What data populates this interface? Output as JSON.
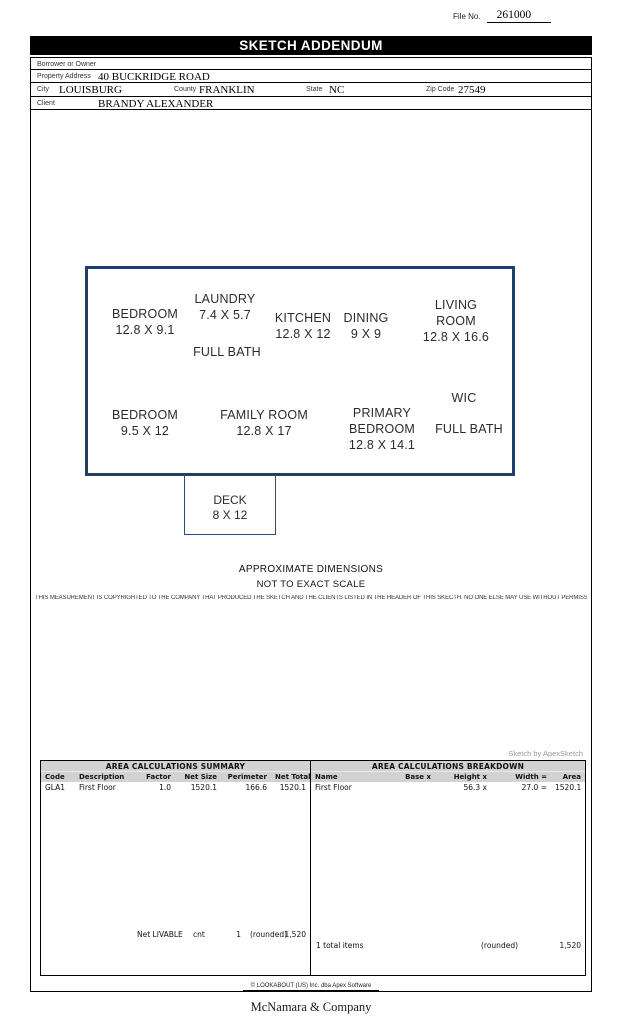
{
  "page": {
    "file_no_label": "File No.",
    "file_no_value": "261000",
    "banner_title": "SKETCH ADDENDUM"
  },
  "form": {
    "borrower_label": "Borrower or Owner",
    "property_address_label": "Property Address",
    "property_address_value": "40 BUCKRIDGE ROAD",
    "city_label": "City",
    "city_value": "LOUISBURG",
    "county_label": "County",
    "county_value": "FRANKLIN",
    "state_label": "State",
    "state_value": "NC",
    "zip_label": "Zip Code",
    "zip_value": "27549",
    "client_label": "Client",
    "client_value": "BRANDY ALEXANDER"
  },
  "sketch": {
    "border_color": "#1f3f63",
    "rooms": [
      {
        "name": "BEDROOM",
        "dims": "12.8 X 9.1"
      },
      {
        "name": "LAUNDRY",
        "dims": "7.4 X 5.7"
      },
      {
        "name": "FULL BATH",
        "dims": ""
      },
      {
        "name": "KITCHEN",
        "dims": "12.8 X 12"
      },
      {
        "name": "DINING",
        "dims": "9 X 9"
      },
      {
        "name": "LIVING ROOM",
        "dims": "12.8 X 16.6"
      },
      {
        "name": "BEDROOM",
        "dims": "9.5 X 12"
      },
      {
        "name": "FAMILY ROOM",
        "dims": "12.8 X 17"
      },
      {
        "name": "PRIMARY BEDROOM",
        "dims": "12.8 X 14.1"
      },
      {
        "name": "WIC",
        "dims": ""
      },
      {
        "name": "FULL BATH",
        "dims": ""
      }
    ],
    "deck_name": "DECK",
    "deck_dims": "8 X 12",
    "note_line1": "APPROXIMATE DIMENSIONS",
    "note_line2": "NOT TO EXACT SCALE",
    "copyright": "THIS MEASUREMENT IS COPYRIGHTED TO THE COMPANY THAT PRODUCED THE SKETCH AND THE CLIENTS LISTED IN THE HEADER OF THIS SKECTH. NO ONE ELSE MAY USE WITHOUT PERMISSION",
    "credit": "Sketch by ApexSketch"
  },
  "summary_table": {
    "title": "AREA CALCULATIONS SUMMARY",
    "headers": [
      "Code",
      "Description",
      "Factor",
      "Net Size",
      "Perimeter",
      "Net Totals"
    ],
    "rows": [
      [
        "GLA1",
        "First Floor",
        "1.0",
        "1520.1",
        "166.6",
        "1520.1"
      ]
    ],
    "footer_label": "Net LIVABLE",
    "footer_cnt_label": "cnt",
    "footer_cnt_value": "1",
    "footer_rounded": "(rounded)",
    "footer_total": "1,520"
  },
  "breakdown_table": {
    "title": "AREA CALCULATIONS BREAKDOWN",
    "headers": [
      "Name",
      "Base  x",
      "Height  x",
      "Width  =",
      "Area"
    ],
    "rows": [
      [
        "First Floor",
        "",
        "56.3  x",
        "27.0  =",
        "1520.1"
      ]
    ],
    "footer_label": "1 total items",
    "footer_rounded": "(rounded)",
    "footer_total": "1,520"
  },
  "footer": {
    "apex_credit": "© LOOKABOUT (US) Inc. dba Apex Software",
    "company": "McNamara & Company"
  }
}
